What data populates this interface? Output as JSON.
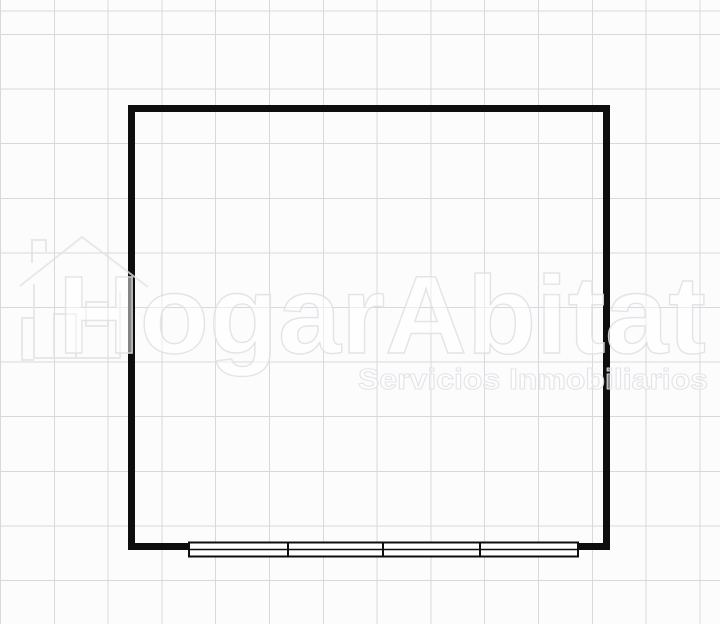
{
  "title": "Floor plan",
  "colors": {
    "background": "#fdfcfd",
    "grid_line": "#d9d9dd",
    "wall": "#0e0e0e",
    "watermark": "#e2e2e6"
  },
  "watermark": {
    "brand": "HogarAbitat",
    "tagline": "Servicios Inmobiliarios",
    "logo": "house-logo-icon"
  },
  "floor_plan": {
    "rooms": 1,
    "window_panes": 4,
    "window_wall": "bottom"
  }
}
